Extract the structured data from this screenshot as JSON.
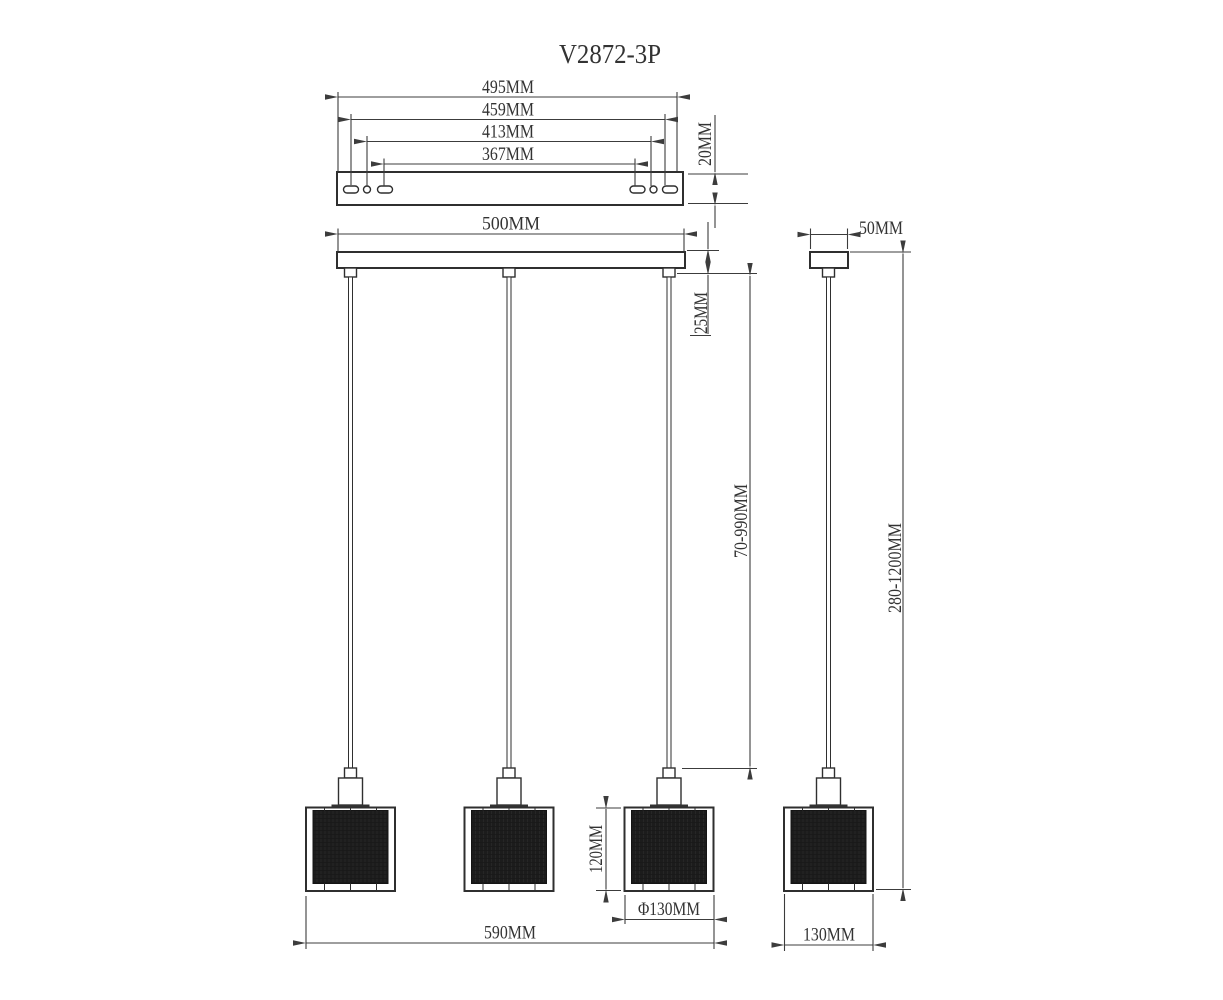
{
  "title": "V2872-3P",
  "views": {
    "bracket": {
      "widths": {
        "d495": "495MM",
        "d459": "459MM",
        "d413": "413MM",
        "d367": "367MM"
      },
      "thickness": "20MM"
    },
    "front": {
      "canopy_width": "500MM",
      "canopy_height": "25MM",
      "suspension_length": "70-990MM",
      "shade_height": "120MM",
      "shade_diameter": "Φ130MM",
      "overall_width": "590MM"
    },
    "side": {
      "canopy_depth": "50MM",
      "overall_height": "280-1200MM",
      "shade_width": "130MM"
    }
  },
  "colors": {
    "line": "#333333",
    "text": "#333333",
    "shade_fill": "#1c1c1c",
    "background": "#ffffff"
  }
}
